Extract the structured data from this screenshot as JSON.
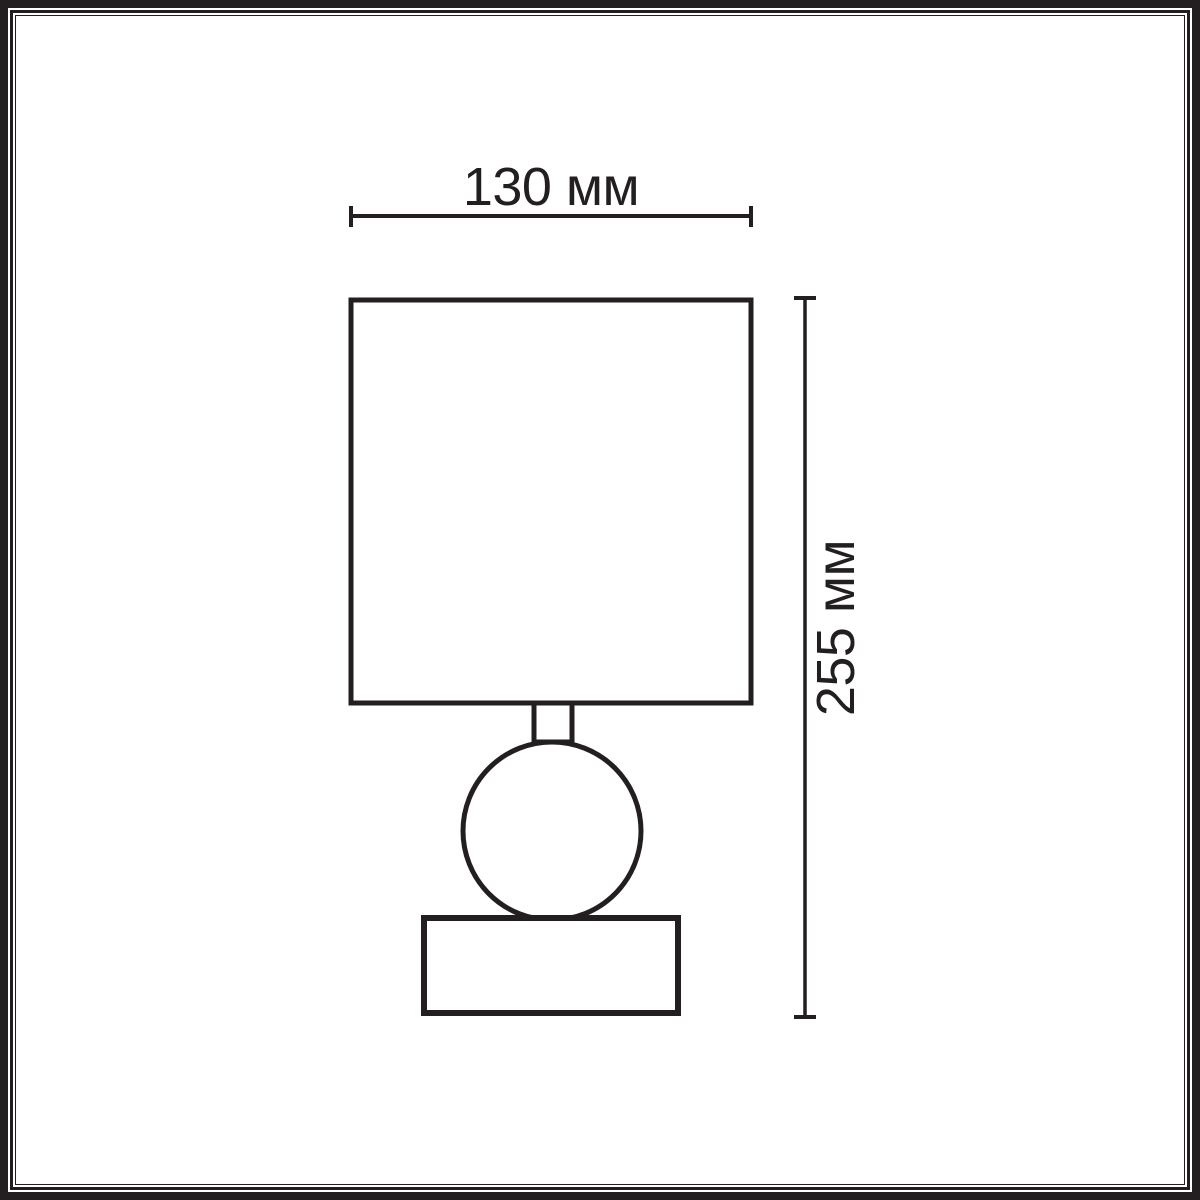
{
  "diagram": {
    "labels": {
      "width": "130 мм",
      "height": "255 мм"
    },
    "colors": {
      "ink": "#231f20",
      "background": "#ffffff"
    }
  }
}
